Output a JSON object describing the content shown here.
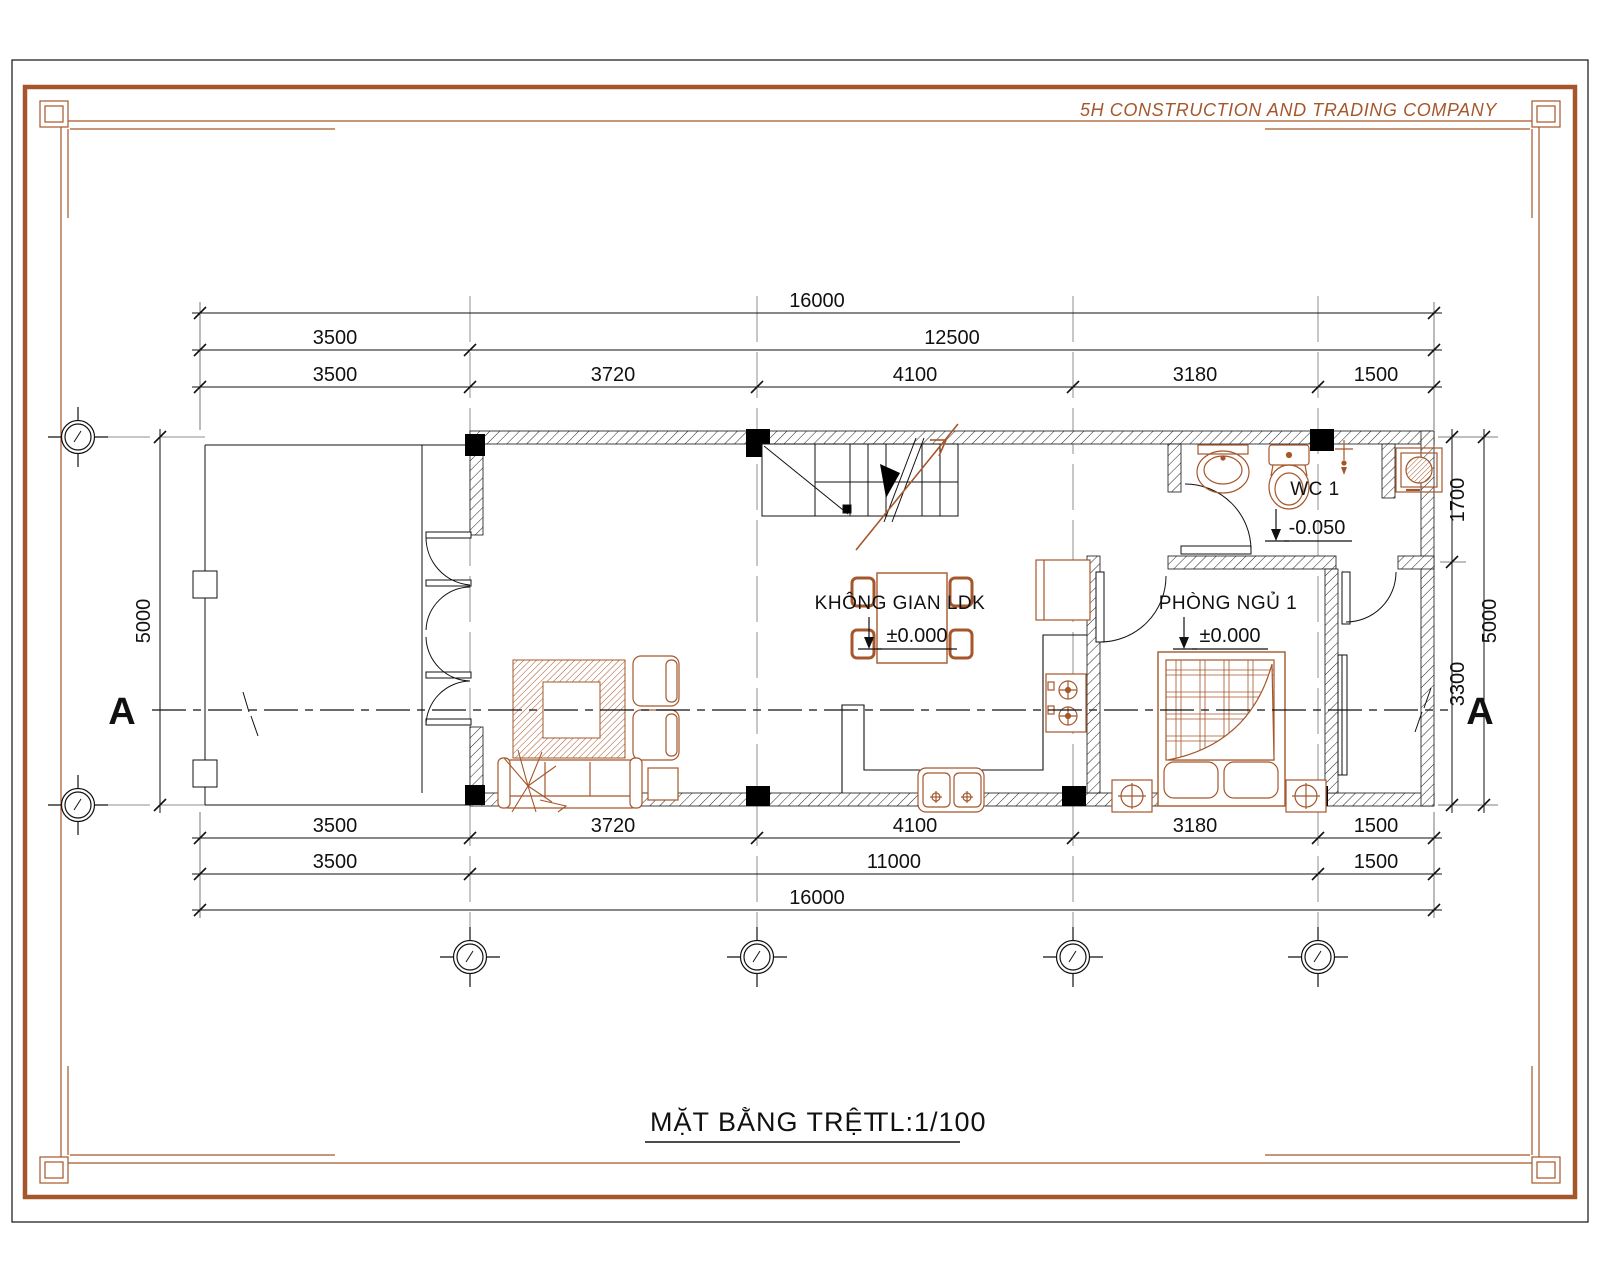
{
  "company": "5H CONSTRUCTION AND TRADING COMPANY",
  "title": {
    "text": "MẶT BẰNG TRỆT",
    "scale": "TL:1/100"
  },
  "rooms": {
    "ldk": {
      "name": "KHÔNG GIAN LDK",
      "level": "±0.000"
    },
    "bedroom": {
      "name": "PHÒNG NGỦ 1",
      "level": "±0.000"
    },
    "wc": {
      "name": "WC 1",
      "level": "-0.050"
    }
  },
  "section": {
    "left": "A",
    "right": "A"
  },
  "dimensions": {
    "top": {
      "overall": "16000",
      "row2": [
        "3500",
        "12500"
      ],
      "row3": [
        "3500",
        "3720",
        "4100",
        "3180",
        "1500"
      ]
    },
    "bottom": {
      "row1": [
        "3500",
        "3720",
        "4100",
        "3180",
        "1500"
      ],
      "row2": [
        "3500",
        "11000",
        "1500"
      ],
      "overall": "16000"
    },
    "left": {
      "overall": "5000"
    },
    "right": {
      "inner": [
        "1700",
        "3300"
      ],
      "outer": "5000"
    }
  },
  "colors": {
    "accent": "#A5572B",
    "furniture": "#A5572B",
    "line": "#111111",
    "grid": "#8f8f8f"
  }
}
